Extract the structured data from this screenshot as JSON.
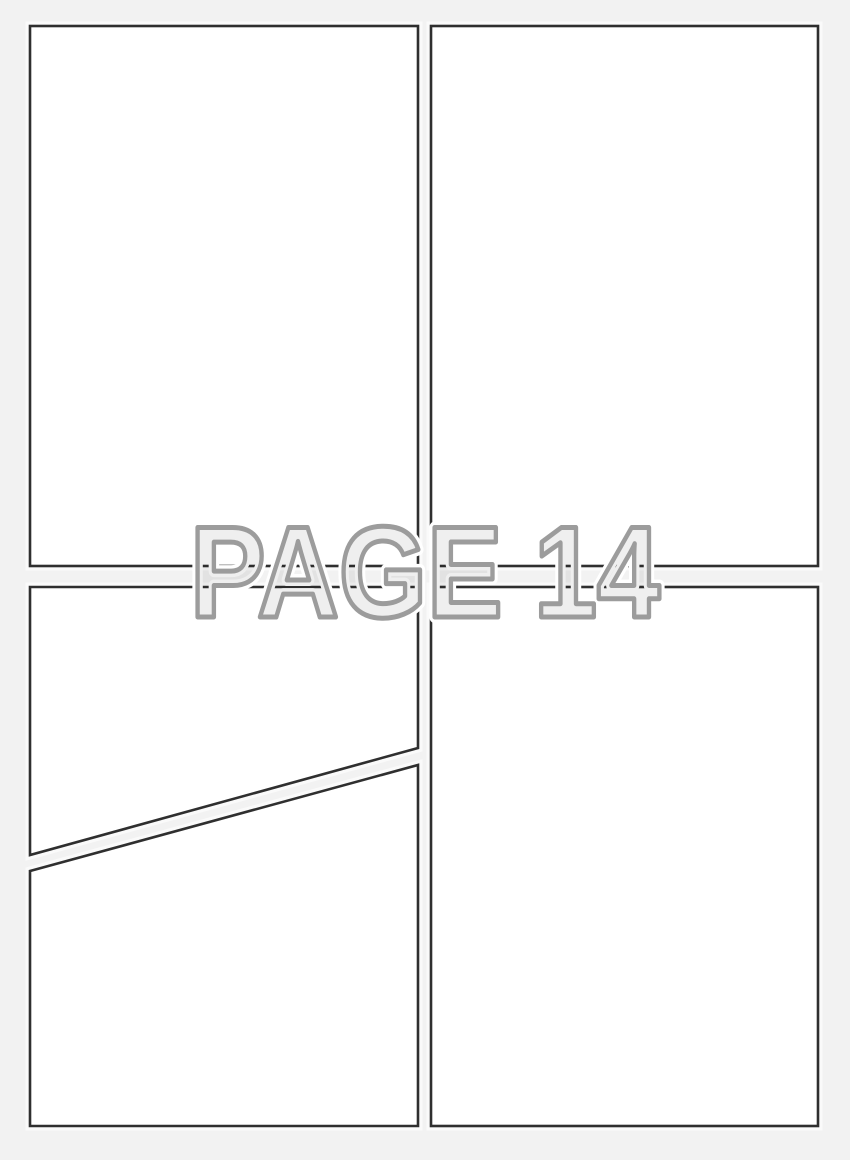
{
  "watermark": {
    "label": "PAGE 14"
  },
  "panels": {
    "count": 5,
    "items": [
      {
        "name": "top-left"
      },
      {
        "name": "top-right"
      },
      {
        "name": "middle-left-above-diagonal"
      },
      {
        "name": "bottom-left-below-diagonal"
      },
      {
        "name": "bottom-right"
      }
    ]
  },
  "colors": {
    "page_background": "#f2f2f2",
    "panel_fill": "#ffffff",
    "panel_border": "#2f2f2f",
    "watermark_fill": "#efefef",
    "watermark_outline": "#9c9c9c",
    "watermark_halo": "#ffffff"
  }
}
